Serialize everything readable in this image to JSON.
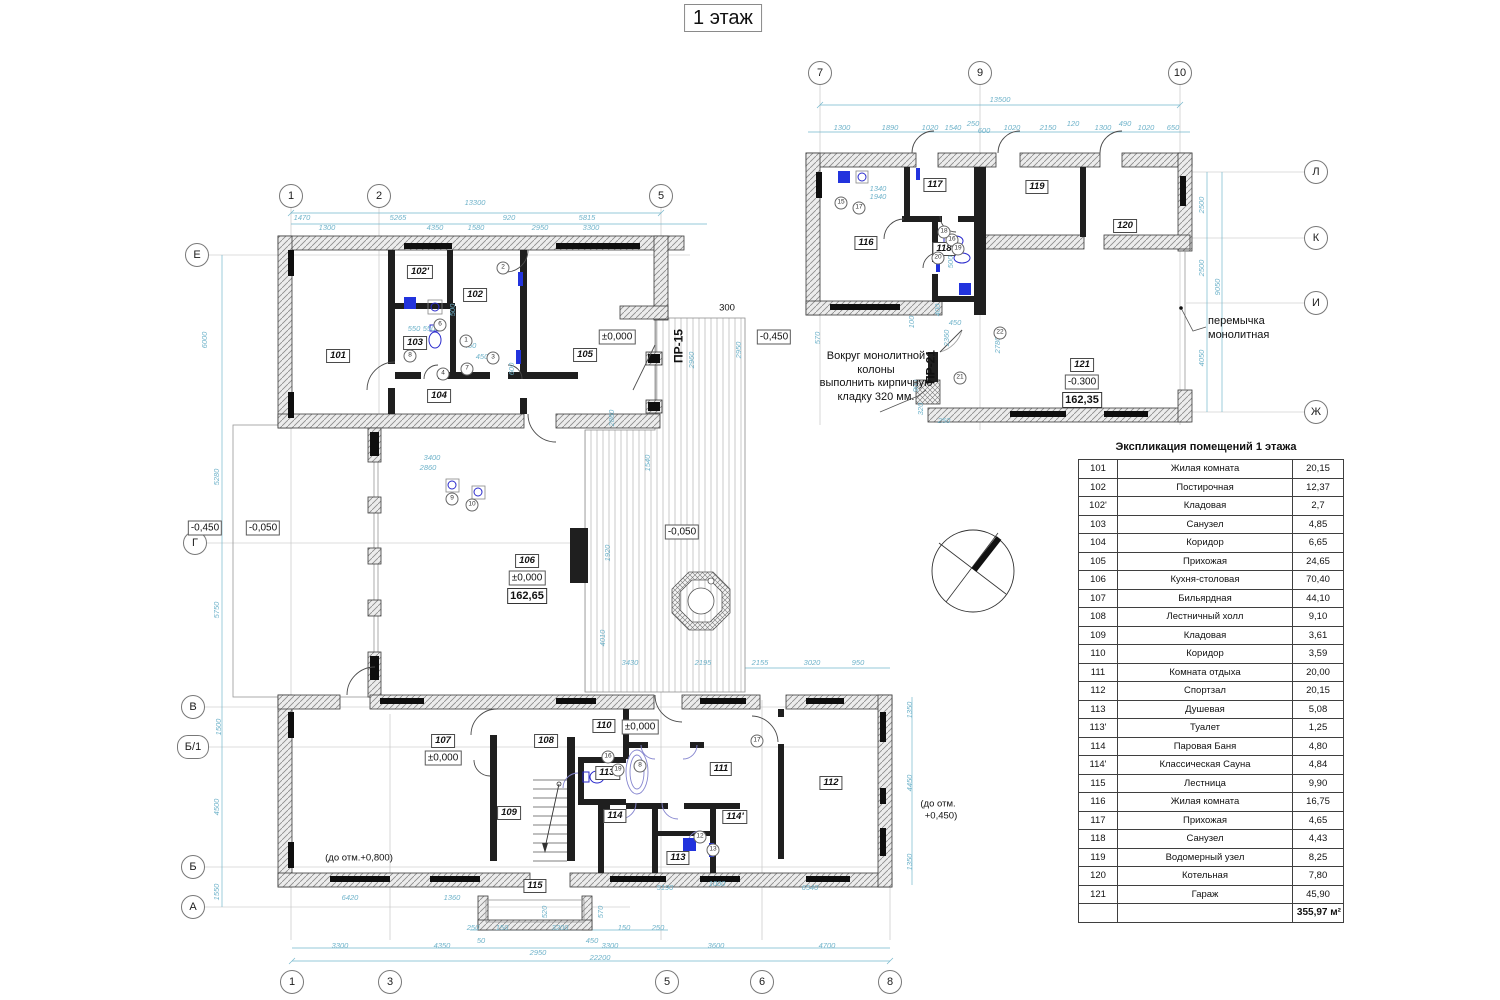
{
  "title": "1 этаж",
  "colors": {
    "dimension": "#6fb3ca",
    "wall": "#1f1f1f",
    "fixture": "#2a2acc",
    "hatch": "#8a8a8a"
  },
  "axes": [
    {
      "label": "1",
      "x": 291,
      "y": 196
    },
    {
      "label": "2",
      "x": 379,
      "y": 196
    },
    {
      "label": "5",
      "x": 661,
      "y": 196
    },
    {
      "label": "1",
      "x": 292,
      "y": 982
    },
    {
      "label": "3",
      "x": 390,
      "y": 982
    },
    {
      "label": "5",
      "x": 667,
      "y": 982
    },
    {
      "label": "6",
      "x": 762,
      "y": 982
    },
    {
      "label": "8",
      "x": 890,
      "y": 982
    },
    {
      "label": "Е",
      "x": 197,
      "y": 255
    },
    {
      "label": "Г",
      "x": 195,
      "y": 543
    },
    {
      "label": "В",
      "x": 193,
      "y": 707
    },
    {
      "label": "Б/1",
      "x": 193,
      "y": 747,
      "wide": true
    },
    {
      "label": "Б",
      "x": 193,
      "y": 867
    },
    {
      "label": "А",
      "x": 193,
      "y": 907
    },
    {
      "label": "7",
      "x": 820,
      "y": 73
    },
    {
      "label": "9",
      "x": 980,
      "y": 73
    },
    {
      "label": "10",
      "x": 1180,
      "y": 73
    },
    {
      "label": "Л",
      "x": 1316,
      "y": 172
    },
    {
      "label": "К",
      "x": 1316,
      "y": 238
    },
    {
      "label": "И",
      "x": 1316,
      "y": 303
    },
    {
      "label": "Ж",
      "x": 1316,
      "y": 412
    }
  ],
  "rooms": [
    {
      "id": "101",
      "x": 338,
      "y": 356
    },
    {
      "id": "102'",
      "x": 420,
      "y": 272
    },
    {
      "id": "102",
      "x": 475,
      "y": 295
    },
    {
      "id": "103",
      "x": 415,
      "y": 343
    },
    {
      "id": "104",
      "x": 439,
      "y": 396
    },
    {
      "id": "105",
      "x": 585,
      "y": 355
    },
    {
      "id": "106",
      "x": 527,
      "y": 561
    },
    {
      "id": "107",
      "x": 443,
      "y": 741
    },
    {
      "id": "108",
      "x": 546,
      "y": 741
    },
    {
      "id": "109",
      "x": 509,
      "y": 813
    },
    {
      "id": "110",
      "x": 604,
      "y": 726
    },
    {
      "id": "111",
      "x": 721,
      "y": 769
    },
    {
      "id": "112",
      "x": 831,
      "y": 783
    },
    {
      "id": "113",
      "x": 678,
      "y": 858
    },
    {
      "id": "113'",
      "x": 608,
      "y": 773
    },
    {
      "id": "114",
      "x": 615,
      "y": 816
    },
    {
      "id": "114'",
      "x": 735,
      "y": 817
    },
    {
      "id": "115",
      "x": 535,
      "y": 886
    },
    {
      "id": "116",
      "x": 866,
      "y": 243
    },
    {
      "id": "117",
      "x": 935,
      "y": 185
    },
    {
      "id": "118",
      "x": 944,
      "y": 249
    },
    {
      "id": "119",
      "x": 1037,
      "y": 187
    },
    {
      "id": "120",
      "x": 1125,
      "y": 226
    },
    {
      "id": "121",
      "x": 1082,
      "y": 365
    }
  ],
  "elevations": [
    {
      "text": "±0,000",
      "x": 617,
      "y": 337
    },
    {
      "text": "-0,450",
      "x": 774,
      "y": 337
    },
    {
      "text": "-0,450",
      "x": 205,
      "y": 528
    },
    {
      "text": "-0,050",
      "x": 263,
      "y": 528
    },
    {
      "text": "-0,050",
      "x": 682,
      "y": 532
    },
    {
      "text": "±0,000",
      "x": 527,
      "y": 578
    },
    {
      "text": "162,65",
      "x": 527,
      "y": 596,
      "bold": true
    },
    {
      "text": "±0,000",
      "x": 443,
      "y": 758
    },
    {
      "text": "±0,000",
      "x": 640,
      "y": 727
    },
    {
      "text": "-0.300",
      "x": 1082,
      "y": 382
    },
    {
      "text": "162,35",
      "x": 1082,
      "y": 400,
      "bold": true
    }
  ],
  "plain_labels": [
    {
      "text": "300",
      "x": 727,
      "y": 308
    },
    {
      "text": "ПР-15",
      "x": 679,
      "y": 346,
      "rot": true,
      "bold": true
    },
    {
      "text": "ПР-21",
      "x": 931,
      "y": 367,
      "rot": true,
      "bold": true
    },
    {
      "text": "(до отм.+0,800)",
      "x": 359,
      "y": 858
    },
    {
      "text": "(до отм.",
      "x": 938,
      "y": 804
    },
    {
      "text": "+0,450)",
      "x": 941,
      "y": 816
    }
  ],
  "annotations": {
    "brick": {
      "lines": [
        "Вокруг монолитной",
        "колоны",
        "выполнить кирпичную",
        "кладку 320 мм."
      ]
    },
    "lintel": {
      "lines": [
        "перемычка",
        "монолитная"
      ]
    }
  },
  "dims": [
    {
      "t": "13300",
      "x": 475,
      "y": 203
    },
    {
      "t": "1470",
      "x": 302,
      "y": 218
    },
    {
      "t": "5265",
      "x": 398,
      "y": 218
    },
    {
      "t": "920",
      "x": 509,
      "y": 218
    },
    {
      "t": "5815",
      "x": 587,
      "y": 218
    },
    {
      "t": "1300",
      "x": 327,
      "y": 228
    },
    {
      "t": "4350",
      "x": 435,
      "y": 228
    },
    {
      "t": "1580",
      "x": 476,
      "y": 228
    },
    {
      "t": "2950",
      "x": 540,
      "y": 228
    },
    {
      "t": "3300",
      "x": 591,
      "y": 228
    },
    {
      "t": "6000",
      "x": 205,
      "y": 340,
      "r": true
    },
    {
      "t": "5280",
      "x": 217,
      "y": 477,
      "r": true
    },
    {
      "t": "5750",
      "x": 217,
      "y": 610,
      "r": true
    },
    {
      "t": "1500",
      "x": 219,
      "y": 727,
      "r": true
    },
    {
      "t": "4500",
      "x": 217,
      "y": 807,
      "r": true
    },
    {
      "t": "1550",
      "x": 217,
      "y": 892,
      "r": true
    },
    {
      "t": "6420",
      "x": 350,
      "y": 898
    },
    {
      "t": "1360",
      "x": 452,
      "y": 898
    },
    {
      "t": "520",
      "x": 545,
      "y": 912,
      "r": true
    },
    {
      "t": "570",
      "x": 601,
      "y": 912,
      "r": true
    },
    {
      "t": "250",
      "x": 473,
      "y": 928
    },
    {
      "t": "150",
      "x": 502,
      "y": 928
    },
    {
      "t": "3200",
      "x": 560,
      "y": 928
    },
    {
      "t": "150",
      "x": 624,
      "y": 928
    },
    {
      "t": "250",
      "x": 658,
      "y": 928
    },
    {
      "t": "50",
      "x": 481,
      "y": 941
    },
    {
      "t": "450",
      "x": 592,
      "y": 941
    },
    {
      "t": "3300",
      "x": 340,
      "y": 946
    },
    {
      "t": "4350",
      "x": 442,
      "y": 946
    },
    {
      "t": "2950",
      "x": 538,
      "y": 953
    },
    {
      "t": "3300",
      "x": 610,
      "y": 946
    },
    {
      "t": "3600",
      "x": 716,
      "y": 946
    },
    {
      "t": "4700",
      "x": 827,
      "y": 946
    },
    {
      "t": "22200",
      "x": 600,
      "y": 958
    },
    {
      "t": "1350",
      "x": 910,
      "y": 710,
      "r": true
    },
    {
      "t": "4450",
      "x": 910,
      "y": 783,
      "r": true
    },
    {
      "t": "1350",
      "x": 910,
      "y": 862,
      "r": true
    },
    {
      "t": "5190",
      "x": 665,
      "y": 888
    },
    {
      "t": "1000",
      "x": 717,
      "y": 884
    },
    {
      "t": "6540",
      "x": 810,
      "y": 888
    },
    {
      "t": "3430",
      "x": 630,
      "y": 663
    },
    {
      "t": "2195",
      "x": 703,
      "y": 663
    },
    {
      "t": "2155",
      "x": 760,
      "y": 663
    },
    {
      "t": "3020",
      "x": 812,
      "y": 663
    },
    {
      "t": "950",
      "x": 858,
      "y": 663
    },
    {
      "t": "1920",
      "x": 608,
      "y": 553,
      "r": true
    },
    {
      "t": "4010",
      "x": 603,
      "y": 638,
      "r": true
    },
    {
      "t": "2960",
      "x": 692,
      "y": 360,
      "r": true
    },
    {
      "t": "2950",
      "x": 739,
      "y": 350,
      "r": true
    },
    {
      "t": "1540",
      "x": 648,
      "y": 463,
      "r": true
    },
    {
      "t": "2860",
      "x": 612,
      "y": 418,
      "r": true
    },
    {
      "t": "3400",
      "x": 432,
      "y": 458
    },
    {
      "t": "2860",
      "x": 428,
      "y": 468
    },
    {
      "t": "550",
      "x": 414,
      "y": 329
    },
    {
      "t": "550",
      "x": 429,
      "y": 329
    },
    {
      "t": "450",
      "x": 470,
      "y": 346
    },
    {
      "t": "450",
      "x": 482,
      "y": 357
    },
    {
      "t": "600",
      "x": 512,
      "y": 369,
      "r": true
    },
    {
      "t": "500",
      "x": 453,
      "y": 310,
      "r": true
    },
    {
      "t": "13500",
      "x": 1000,
      "y": 100
    },
    {
      "t": "1300",
      "x": 842,
      "y": 128
    },
    {
      "t": "1890",
      "x": 890,
      "y": 128
    },
    {
      "t": "1020",
      "x": 930,
      "y": 128
    },
    {
      "t": "1540",
      "x": 953,
      "y": 128
    },
    {
      "t": "250",
      "x": 973,
      "y": 124
    },
    {
      "t": "600",
      "x": 984,
      "y": 131
    },
    {
      "t": "1020",
      "x": 1012,
      "y": 128
    },
    {
      "t": "2150",
      "x": 1048,
      "y": 128
    },
    {
      "t": "120",
      "x": 1073,
      "y": 124
    },
    {
      "t": "1300",
      "x": 1103,
      "y": 128
    },
    {
      "t": "490",
      "x": 1125,
      "y": 124
    },
    {
      "t": "1020",
      "x": 1146,
      "y": 128
    },
    {
      "t": "650",
      "x": 1173,
      "y": 128
    },
    {
      "t": "2500",
      "x": 1202,
      "y": 205,
      "r": true
    },
    {
      "t": "2500",
      "x": 1202,
      "y": 268,
      "r": true
    },
    {
      "t": "9050",
      "x": 1218,
      "y": 287,
      "r": true
    },
    {
      "t": "4050",
      "x": 1202,
      "y": 358,
      "r": true
    },
    {
      "t": "1340",
      "x": 878,
      "y": 189
    },
    {
      "t": "1940",
      "x": 878,
      "y": 197
    },
    {
      "t": "570",
      "x": 818,
      "y": 338,
      "r": true
    },
    {
      "t": "2360",
      "x": 947,
      "y": 338,
      "r": true
    },
    {
      "t": "2780",
      "x": 998,
      "y": 345,
      "r": true
    },
    {
      "t": "900",
      "x": 916,
      "y": 386,
      "r": true
    },
    {
      "t": "450",
      "x": 955,
      "y": 323
    },
    {
      "t": "400",
      "x": 938,
      "y": 310,
      "r": true
    },
    {
      "t": "320",
      "x": 921,
      "y": 409,
      "r": true
    },
    {
      "t": "250",
      "x": 944,
      "y": 421
    },
    {
      "t": "100",
      "x": 912,
      "y": 322,
      "r": true
    },
    {
      "t": "500",
      "x": 951,
      "y": 262,
      "r": true
    }
  ],
  "refs": [
    {
      "n": "1",
      "x": 466,
      "y": 341
    },
    {
      "n": "2",
      "x": 503,
      "y": 268
    },
    {
      "n": "3",
      "x": 493,
      "y": 358
    },
    {
      "n": "4",
      "x": 443,
      "y": 374
    },
    {
      "n": "6",
      "x": 440,
      "y": 325
    },
    {
      "n": "7",
      "x": 467,
      "y": 369
    },
    {
      "n": "8",
      "x": 410,
      "y": 356
    },
    {
      "n": "9",
      "x": 452,
      "y": 499
    },
    {
      "n": "10",
      "x": 472,
      "y": 505
    },
    {
      "n": "16",
      "x": 608,
      "y": 757
    },
    {
      "n": "19",
      "x": 618,
      "y": 770
    },
    {
      "n": "17",
      "x": 757,
      "y": 741
    },
    {
      "n": "8",
      "x": 640,
      "y": 766
    },
    {
      "n": "12",
      "x": 700,
      "y": 837
    },
    {
      "n": "13",
      "x": 713,
      "y": 850
    },
    {
      "n": "15",
      "x": 841,
      "y": 203
    },
    {
      "n": "17",
      "x": 859,
      "y": 208
    },
    {
      "n": "16",
      "x": 952,
      "y": 240
    },
    {
      "n": "19",
      "x": 958,
      "y": 249
    },
    {
      "n": "18",
      "x": 944,
      "y": 232
    },
    {
      "n": "20",
      "x": 938,
      "y": 258
    },
    {
      "n": "21",
      "x": 960,
      "y": 378
    },
    {
      "n": "22",
      "x": 1000,
      "y": 333
    }
  ],
  "table": {
    "title": "Экспликация помещений 1 этажа",
    "rows": [
      [
        "101",
        "Жилая комната",
        "20,15"
      ],
      [
        "102",
        "Постирочная",
        "12,37"
      ],
      [
        "102'",
        "Кладовая",
        "2,7"
      ],
      [
        "103",
        "Санузел",
        "4,85"
      ],
      [
        "104",
        "Коридор",
        "6,65"
      ],
      [
        "105",
        "Прихожая",
        "24,65"
      ],
      [
        "106",
        "Кухня-столовая",
        "70,40"
      ],
      [
        "107",
        "Бильярдная",
        "44,10"
      ],
      [
        "108",
        "Лестничный холл",
        "9,10"
      ],
      [
        "109",
        "Кладовая",
        "3,61"
      ],
      [
        "110",
        "Коридор",
        "3,59"
      ],
      [
        "111",
        "Комната отдыха",
        "20,00"
      ],
      [
        "112",
        "Спортзал",
        "20,15"
      ],
      [
        "113",
        "Душевая",
        "5,08"
      ],
      [
        "113'",
        "Туалет",
        "1,25"
      ],
      [
        "114",
        "Паровая Баня",
        "4,80"
      ],
      [
        "114'",
        "Классическая Сауна",
        "4,84"
      ],
      [
        "115",
        "Лестница",
        "9,90"
      ],
      [
        "116",
        "Жилая комната",
        "16,75"
      ],
      [
        "117",
        "Прихожая",
        "4,65"
      ],
      [
        "118",
        "Санузел",
        "4,43"
      ],
      [
        "119",
        "Водомерный узел",
        "8,25"
      ],
      [
        "120",
        "Котельная",
        "7,80"
      ],
      [
        "121",
        "Гараж",
        "45,90"
      ]
    ],
    "total": "355,97 м²"
  }
}
